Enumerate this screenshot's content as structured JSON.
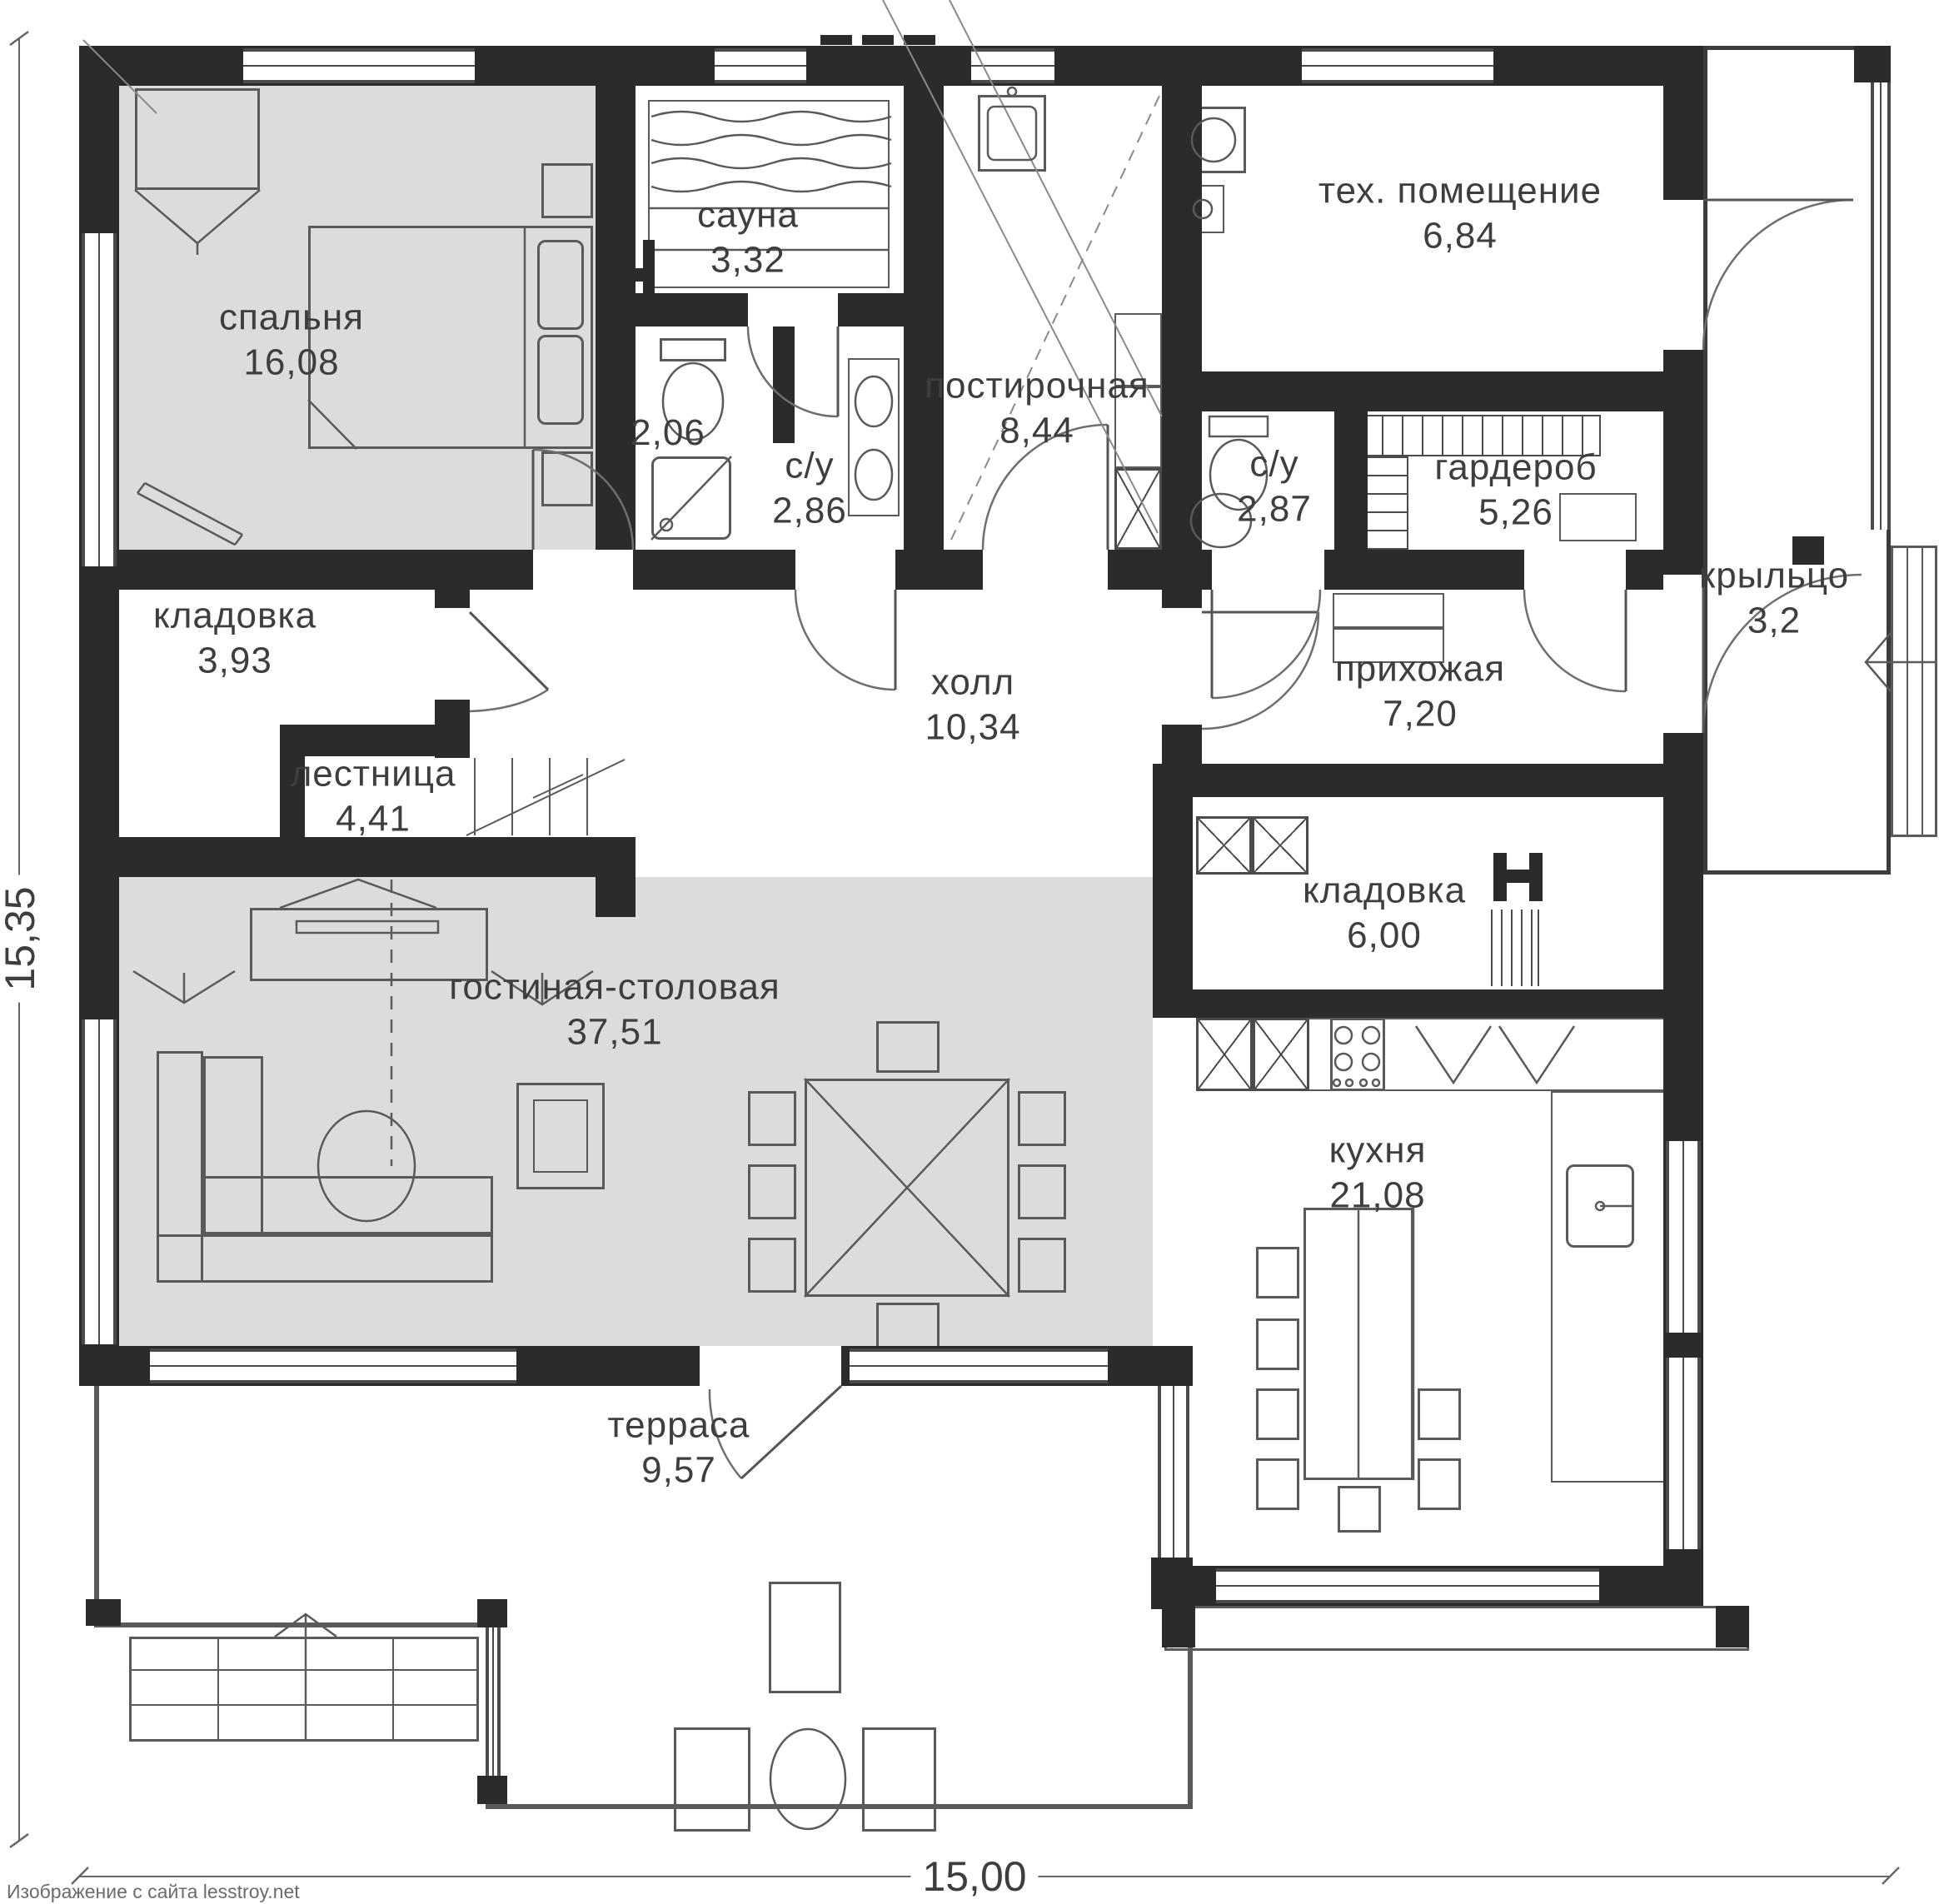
{
  "watermark": "Изображение с сайта lesstroy.net",
  "dimensions": {
    "bottom": "15,00",
    "left": "15,35"
  },
  "colors": {
    "wall": "#2b2b2b",
    "room_fill": "#dcdcdc",
    "line_dark": "#4b4b4b",
    "line_light": "#777777",
    "text": "#3e3e3e"
  },
  "rooms": [
    {
      "id": "bedroom",
      "name": "спальня",
      "area": "16,08"
    },
    {
      "id": "sauna",
      "name": "сауна",
      "area": "3,32"
    },
    {
      "id": "shower-room",
      "name": "",
      "area": "2,06"
    },
    {
      "id": "bathroom-1",
      "name": "с/у",
      "area": "2,86"
    },
    {
      "id": "laundry",
      "name": "постирочная",
      "area": "8,44"
    },
    {
      "id": "tech-room",
      "name": "тех. помещение",
      "area": "6,84"
    },
    {
      "id": "bathroom-2",
      "name": "с/у",
      "area": "2,87"
    },
    {
      "id": "wardrobe",
      "name": "гардероб",
      "area": "5,26"
    },
    {
      "id": "storage-1",
      "name": "кладовка",
      "area": "3,93"
    },
    {
      "id": "stairs",
      "name": "лестница",
      "area": "4,41"
    },
    {
      "id": "hall",
      "name": "холл",
      "area": "10,34"
    },
    {
      "id": "entry",
      "name": "прихожая",
      "area": "7,20"
    },
    {
      "id": "porch",
      "name": "крыльцо",
      "area": "3,2"
    },
    {
      "id": "storage-2",
      "name": "кладовка",
      "area": "6,00"
    },
    {
      "id": "living-dining",
      "name": "гостиная-столовая",
      "area": "37,51"
    },
    {
      "id": "kitchen",
      "name": "кухня",
      "area": "21,08"
    },
    {
      "id": "terrace",
      "name": "терраса",
      "area": "9,57"
    }
  ]
}
